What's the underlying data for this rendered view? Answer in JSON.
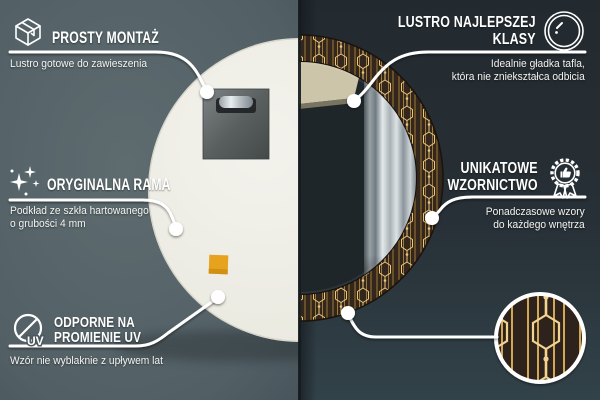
{
  "image_type": "product-infographic",
  "product": "round decorative mirror with art-deco golden pattern frame",
  "colors": {
    "left_wall": "#57646a",
    "right_wall": "#262d32",
    "mirror_back": "#eeede4",
    "frame_base": "#33261c",
    "frame_gold": "#d9ab54",
    "callout_line": "#ffffff",
    "mounting_pad": "#e7a31d"
  },
  "callouts": {
    "prosty_montaz": {
      "icon": "package-box-icon",
      "title": "PROSTY MONTAŻ",
      "subtitle": "Lustro gotowe do zawieszenia"
    },
    "oryginalna_rama": {
      "icon": "sparkles-icon",
      "title": "ORYGINALNA RAMA",
      "subtitle_line1": "Podkład ze szkła hartowanego",
      "subtitle_line2": "o grubości 4 mm"
    },
    "odporne_uv": {
      "icon": "no-uv-icon",
      "uv_label": "UV",
      "title_line1": "ODPORNE NA",
      "title_line2": "PROMIENIE UV",
      "subtitle": "Wzór nie wyblaknie z upływem lat"
    },
    "lustro_klasy": {
      "icon": "mirror-shine-icon",
      "title_line1": "LUSTRO NAJLEPSZEJ",
      "title_line2": "KLASY",
      "subtitle_line1": "Idealnie gładka tafla,",
      "subtitle_line2": "która nie zniekształca odbicia"
    },
    "unikatowe_wzornictwo": {
      "icon": "award-badge-icon",
      "title_line1": "UNIKATOWE",
      "title_line2": "WZORNICTWO",
      "subtitle_line1": "Ponadczasowe wzory",
      "subtitle_line2": "do każdego wnętrza"
    },
    "pattern_detail": {
      "icon": "pattern-zoom-circle"
    }
  }
}
